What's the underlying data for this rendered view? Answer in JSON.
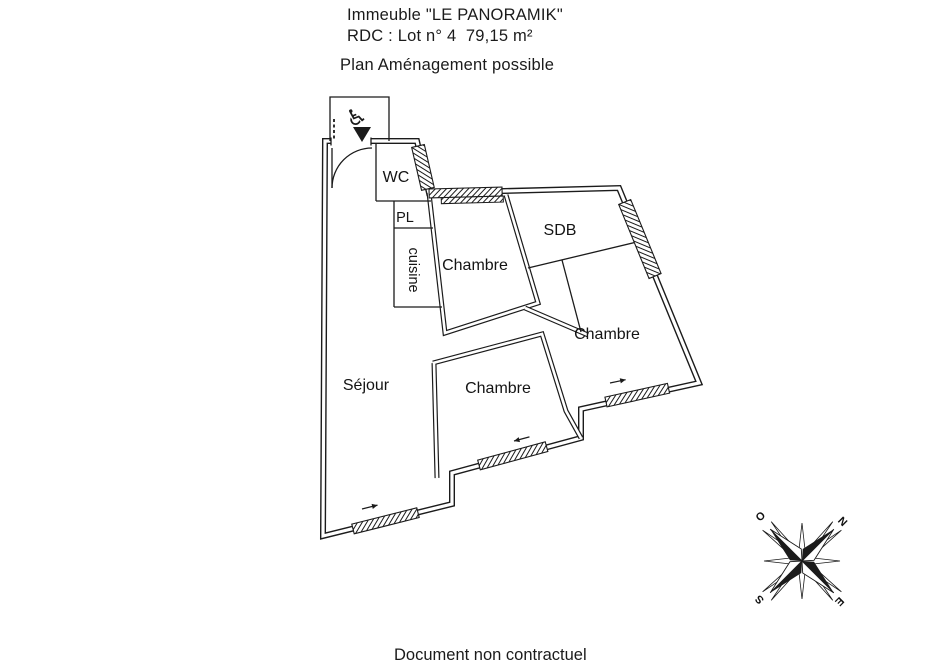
{
  "header": {
    "building": "Immeuble \"LE PANORAMIK\"",
    "lot": "RDC : Lot n° 4  79,15 m²",
    "plan_title": "Plan Aménagement possible"
  },
  "rooms": {
    "wc": "WC",
    "pl": "PL",
    "cuisine": "cuisine",
    "chambre_top": "Chambre",
    "sdb": "SDB",
    "chambre_east": "Chambre",
    "chambre_middle": "Chambre",
    "sejour": "Séjour"
  },
  "compass": {
    "north": "N",
    "east": "E",
    "south": "S",
    "west": "O"
  },
  "symbols": {
    "accessibility": "♿"
  },
  "footer": {
    "disclaimer": "Document non contractuel"
  },
  "colors": {
    "ink": "#1b1b1b",
    "paper": "#ffffff"
  }
}
